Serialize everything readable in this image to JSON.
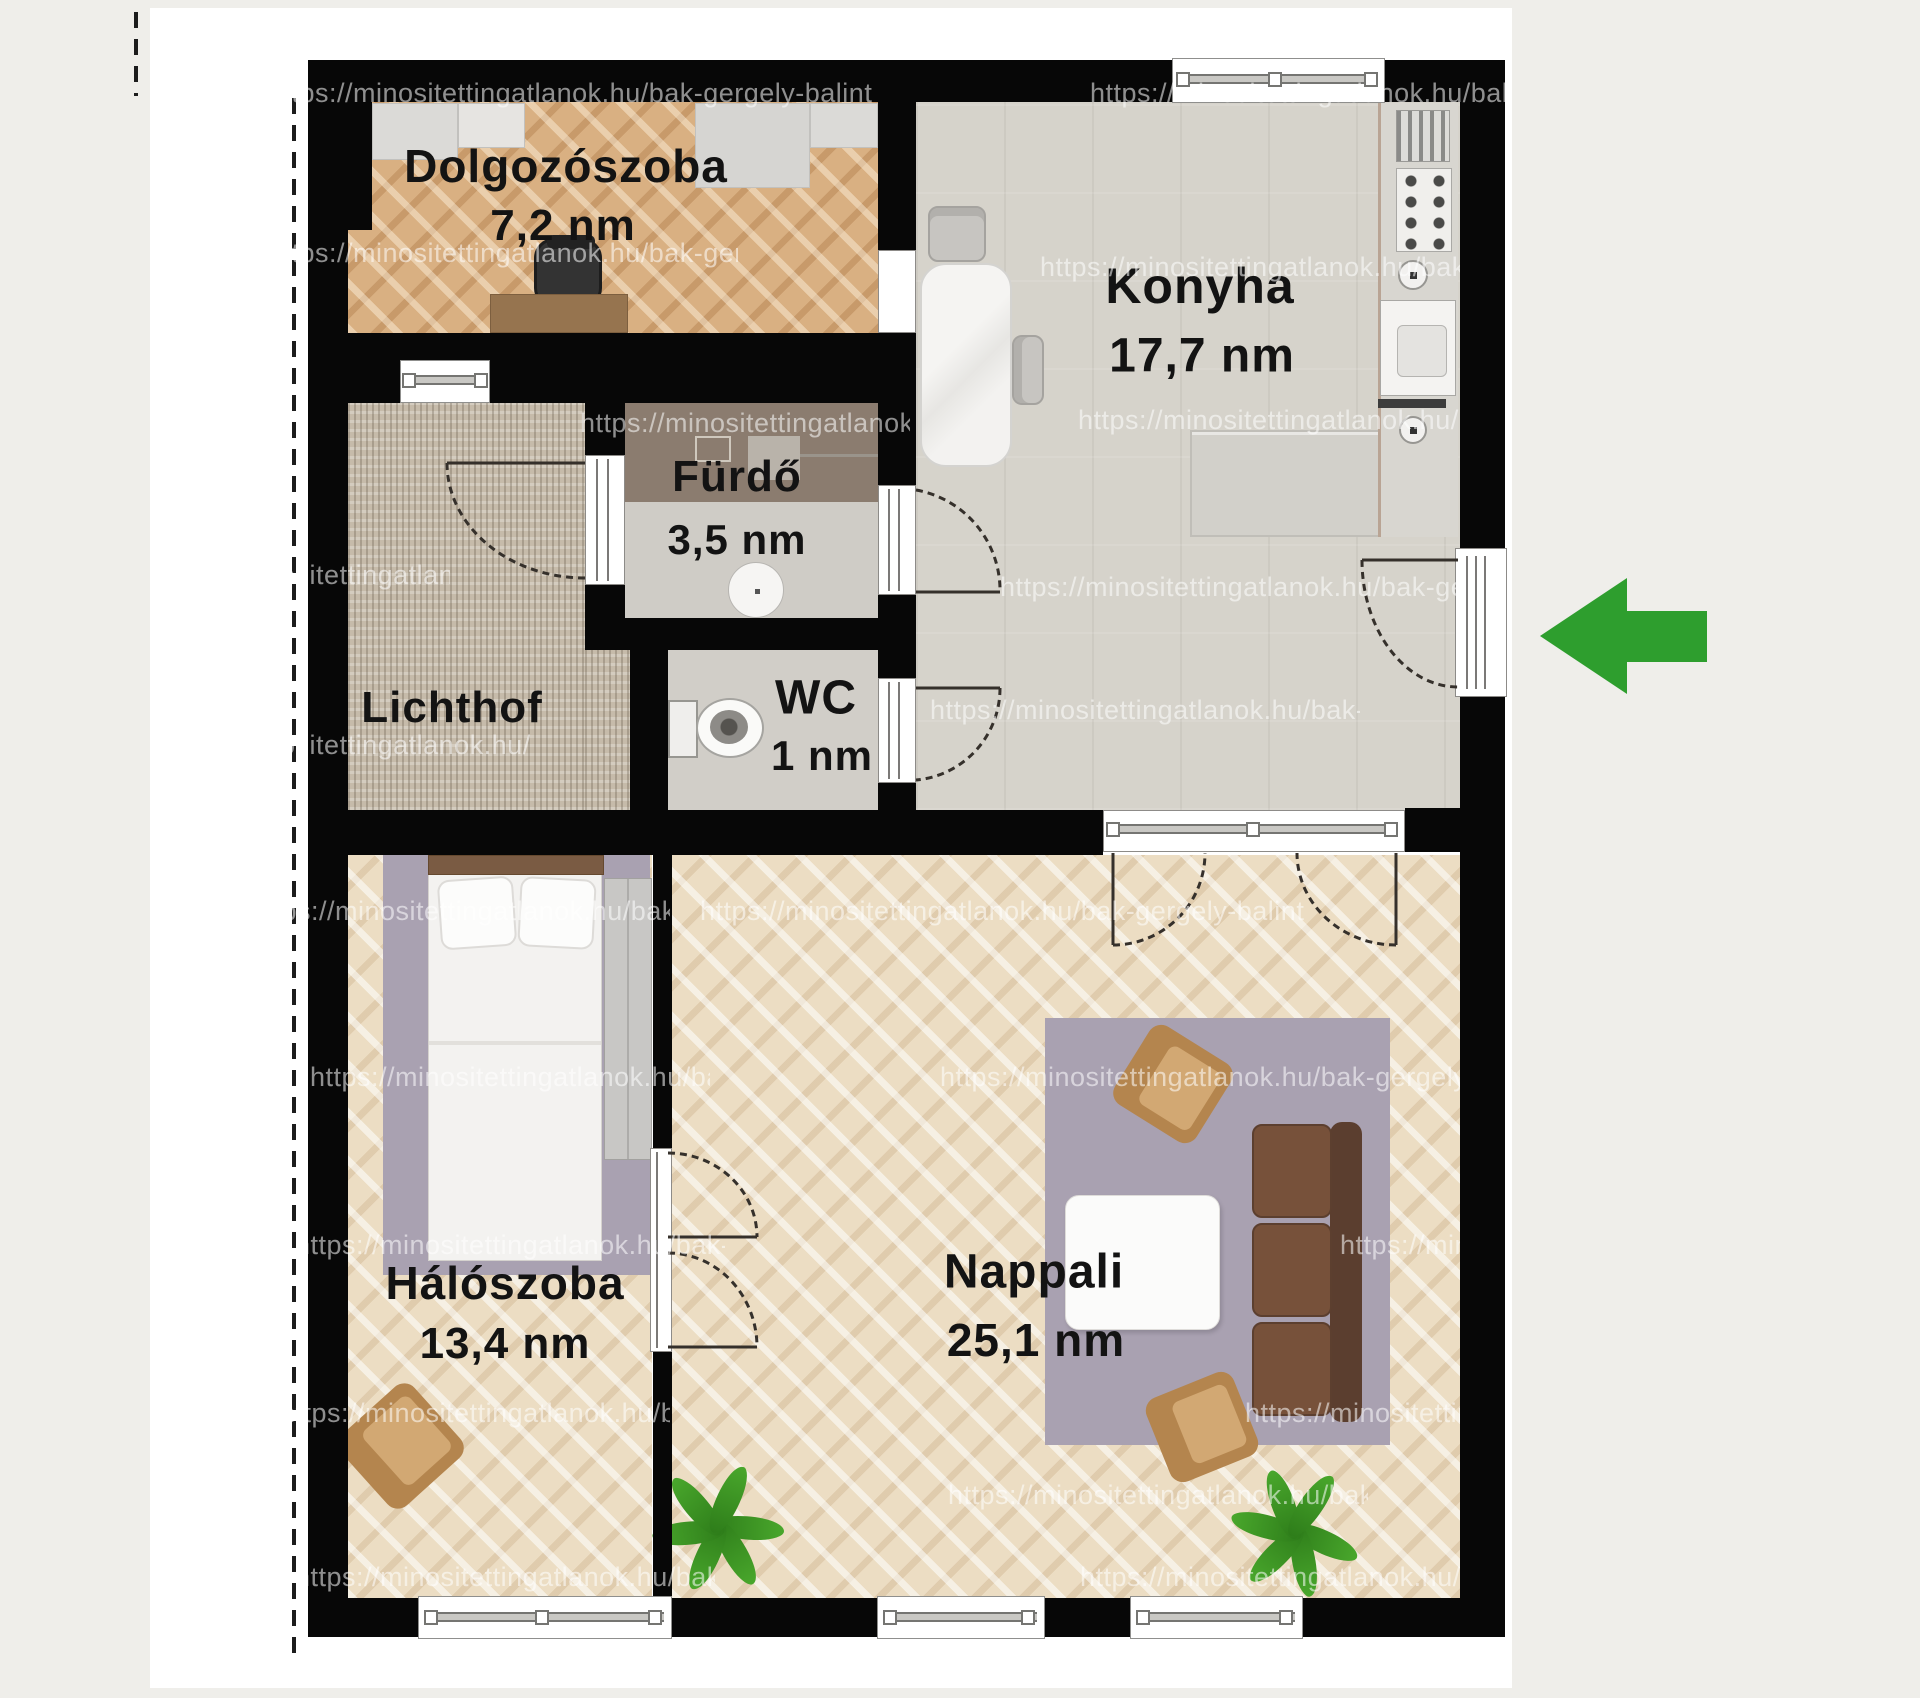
{
  "plan": {
    "type": "apartment floor plan",
    "language": "hu"
  },
  "rooms": [
    {
      "id": "dolgozoszoba",
      "name": "Dolgozószoba",
      "area": "7,2 nm"
    },
    {
      "id": "konyha",
      "name": "Konyha",
      "area": "17,7 nm"
    },
    {
      "id": "furdo",
      "name": "Fürdő",
      "area": "3,5 nm"
    },
    {
      "id": "wc",
      "name": "WC",
      "area": "1 nm"
    },
    {
      "id": "lichthof",
      "name": "Lichthof",
      "area": ""
    },
    {
      "id": "haloszoba",
      "name": "Hálószoba",
      "area": "13,4 nm"
    },
    {
      "id": "nappali",
      "name": "Nappali",
      "area": "25,1 nm"
    }
  ],
  "watermark": {
    "text": "https://minositettingatlanok.hu/bak-gergely-balint"
  },
  "colors": {
    "entry_arrow": "#2e9e2e",
    "wall": "#070707",
    "sheet": "#ffffff",
    "background": "#efeeea",
    "rug": "#a9a1b1",
    "study_floor": "#d9b082",
    "living_floor": "#ecddc3",
    "kitchen_floor": "#d6d3cb"
  }
}
